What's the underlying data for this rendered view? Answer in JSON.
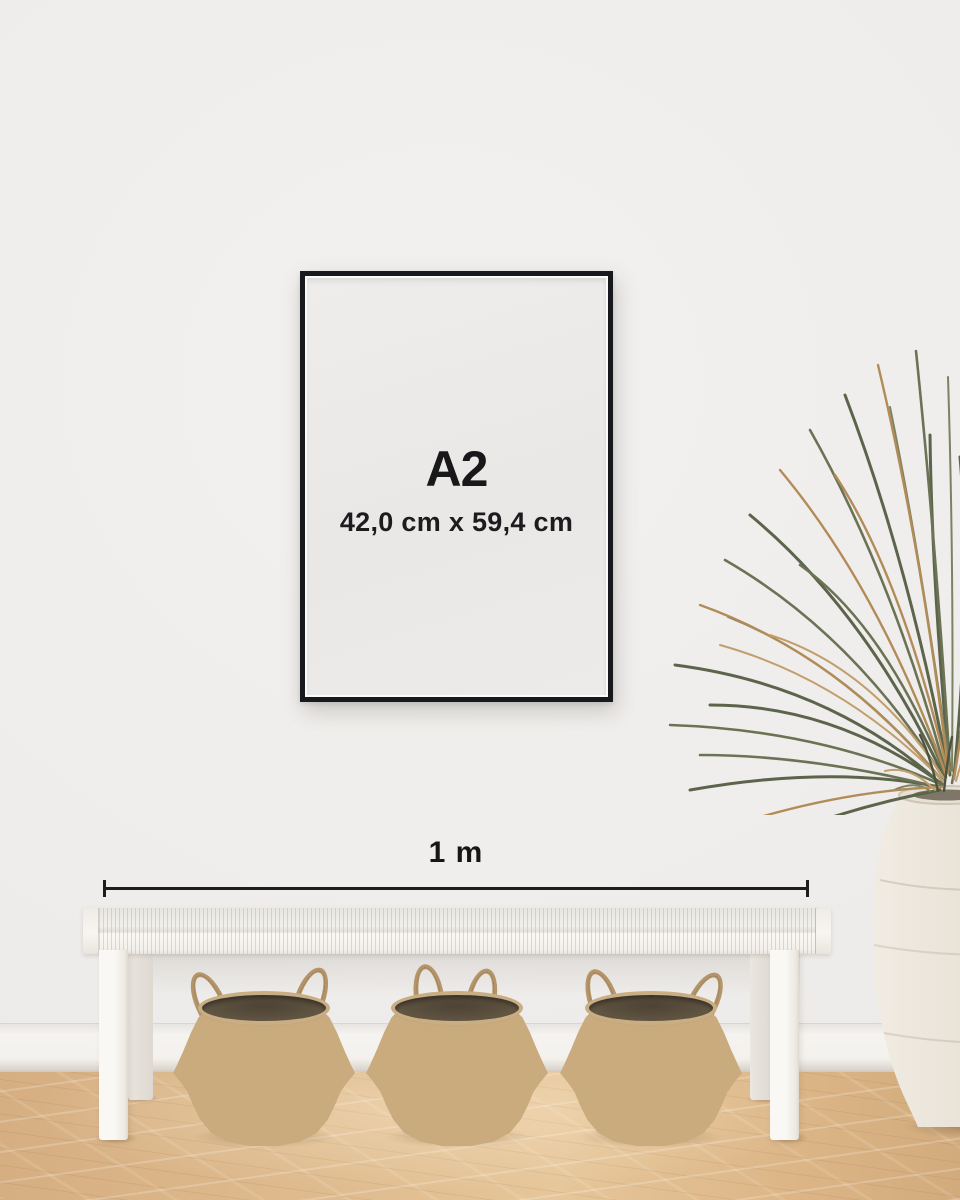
{
  "scene": {
    "description": "Poster size mockup interior",
    "poster": {
      "size_label": "A2",
      "dimensions_label": "42,0 cm x 59,4 cm"
    },
    "measurement": {
      "label": "1 m"
    },
    "colors": {
      "wall": "#EFEDEB",
      "frame": "#17191D",
      "poster_paper": "#ECEAE8",
      "text": "#1A1A1A",
      "floor_wood": "#DFBB8E",
      "basket_weave": "#C9AB7E",
      "bench_white": "#F2F0EC",
      "vase_white": "#EBE5DB",
      "plant_green": "#5C644B",
      "plant_tan": "#B8935F"
    }
  }
}
